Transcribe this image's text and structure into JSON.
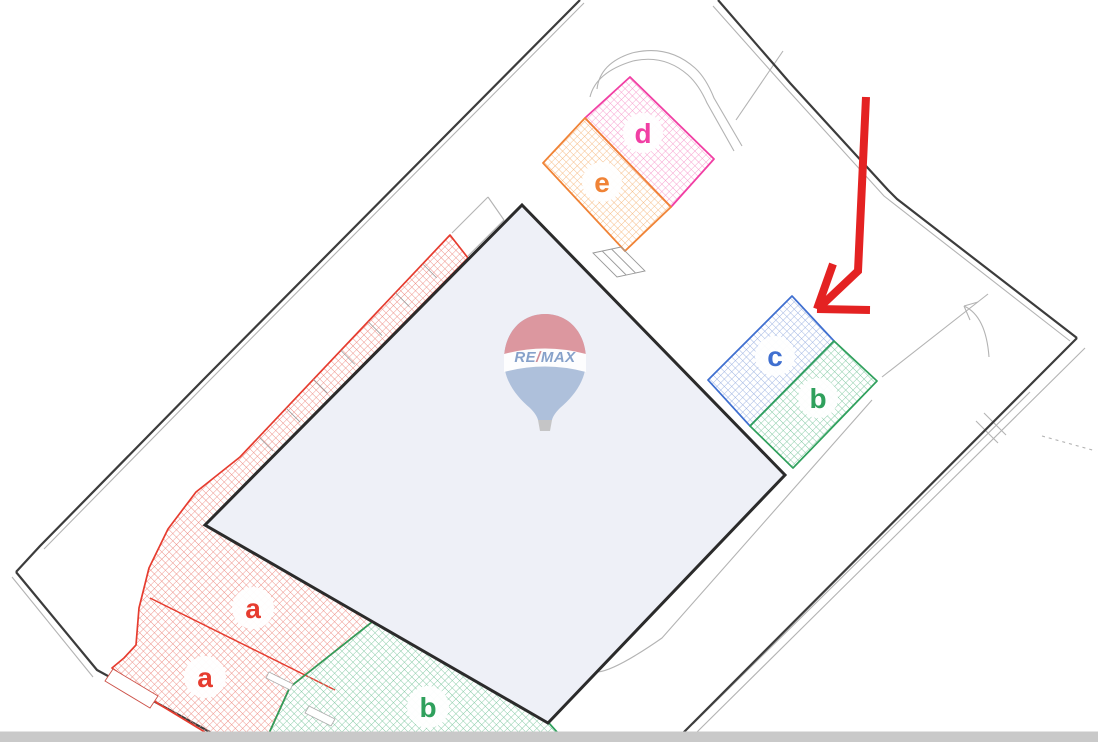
{
  "plan": {
    "description": "Scanned cadastral site plan with hatched parcel zones and hand-drawn arrow annotation",
    "background": "#ffffff"
  },
  "zones": {
    "a": {
      "label": "a",
      "color": "#e63c2f",
      "hatch": "#ee8e85",
      "instances": 2
    },
    "b": {
      "label": "b",
      "color": "#2fa05c",
      "hatch": "#82c9a3",
      "instances": 2
    },
    "c": {
      "label": "c",
      "color": "#3f6fd0",
      "hatch": "#9db3e2",
      "instances": 1
    },
    "d": {
      "label": "d",
      "color": "#f13fa4",
      "hatch": "#f79ccd",
      "instances": 1
    },
    "e": {
      "label": "e",
      "color": "#f08336",
      "hatch": "#f6bb83",
      "instances": 1
    }
  },
  "watermark": {
    "brand_left": "RE",
    "brand_slash": "/",
    "brand_right": "MAX",
    "text_color": "#7e9bc7",
    "slash_color": "#cf8691",
    "top_color": "#db9098",
    "band_color": "#ffffff",
    "bottom_color": "#a9bdd9",
    "basket_color": "#c2c2c2"
  },
  "annotation": {
    "arrow_color": "#e42222",
    "target_zone": "c"
  },
  "colors": {
    "boundary": "#3c3c3c",
    "road": "#b3b3b3",
    "building_fill": "#eef0f7",
    "building_stroke": "#2b2b2b",
    "halo": "#ffffff",
    "scan_bar": "#c9c9c9"
  }
}
